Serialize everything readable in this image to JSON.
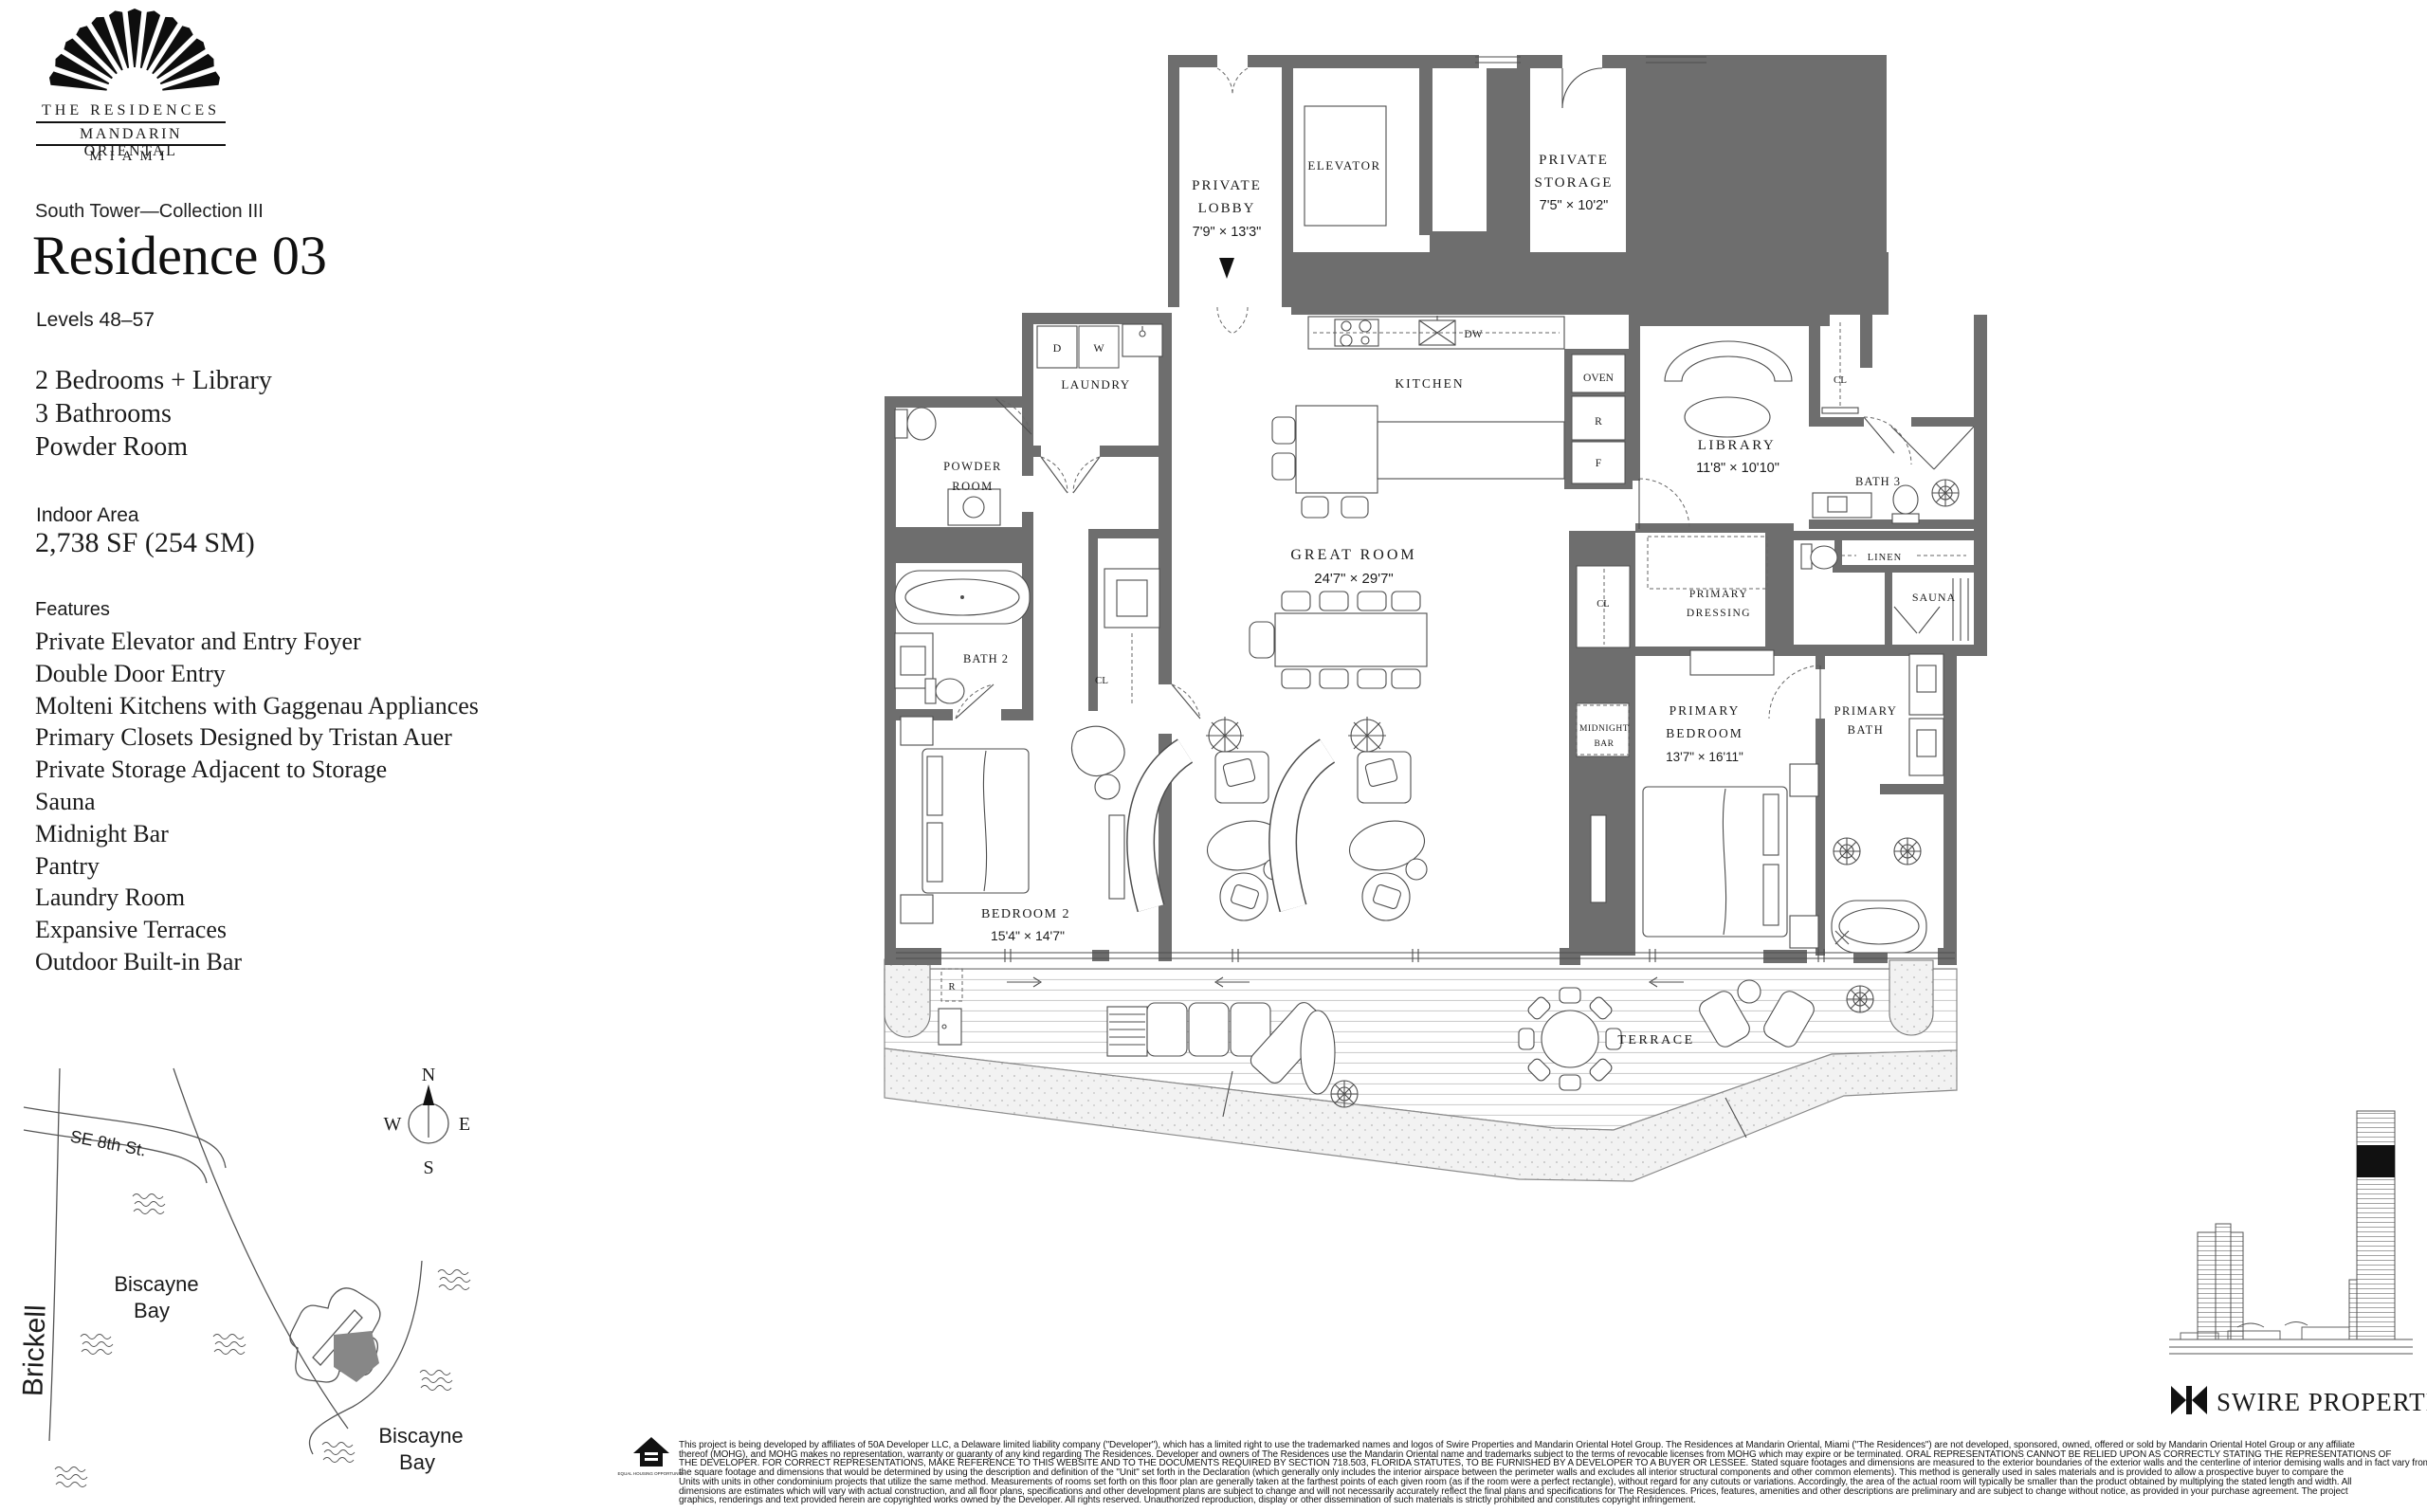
{
  "brand": {
    "fan_icon": "mandarin-oriental-fan",
    "residences": "THE RESIDENCES",
    "hotel": "MANDARIN ORIENTAL",
    "city": "MIAMI"
  },
  "header": {
    "collection": "South Tower—Collection III",
    "title": "Residence 03",
    "levels": "Levels 48–57"
  },
  "summary": {
    "lines": [
      "2 Bedrooms + Library",
      "3 Bathrooms",
      "Powder Room"
    ],
    "area_label": "Indoor Area",
    "area_value": "2,738 SF (254 SM)"
  },
  "features": {
    "label": "Features",
    "items": [
      "Private Elevator and Entry Foyer",
      "Double Door Entry",
      "Molteni Kitchens with Gaggenau Appliances",
      "Primary Closets Designed by Tristan Auer",
      "Private Storage Adjacent to Storage",
      "Sauna",
      "Midnight Bar",
      "Pantry",
      "Laundry Room",
      "Expansive Terraces",
      "Outdoor Built-in Bar"
    ]
  },
  "plan": {
    "private_lobby": {
      "l1": "PRIVATE",
      "l2": "LOBBY",
      "dims": "7'9\" × 13'3\""
    },
    "elevator": "ELEVATOR",
    "private_storage": {
      "l1": "PRIVATE",
      "l2": "STORAGE",
      "dims": "7'5\" × 10'2\""
    },
    "laundry": "LAUNDRY",
    "dryer": "D",
    "washer": "W",
    "dishwasher": "DW",
    "kitchen": "KITCHEN",
    "oven": "OVEN",
    "refrigerator": "R",
    "freezer": "F",
    "powder": {
      "l1": "POWDER",
      "l2": "ROOM"
    },
    "bath2": "BATH 2",
    "closet_bedroom2": "CL",
    "closet_hall": "CL",
    "closet_dressing": "CL",
    "great_room": {
      "l1": "GREAT ROOM",
      "dims": "24'7\" × 29'7\""
    },
    "library": {
      "l1": "LIBRARY",
      "dims": "11'8\" × 10'10\""
    },
    "bath3": "BATH 3",
    "linen": "LINEN",
    "sauna": "SAUNA",
    "dressing": {
      "l1": "PRIMARY",
      "l2": "DRESSING"
    },
    "midnight_bar": {
      "l1": "MIDNIGHT",
      "l2": "BAR"
    },
    "primary_bedroom": {
      "l1": "PRIMARY",
      "l2": "BEDROOM",
      "dims": "13'7\" × 16'11\""
    },
    "primary_bath": {
      "l1": "PRIMARY",
      "l2": "BATH"
    },
    "bedroom2": {
      "l1": "BEDROOM 2",
      "dims": "15'4\" × 14'7\""
    },
    "terrace": "TERRACE",
    "outdoor_refrigerator": "R",
    "wall_color": "#6e6e6e"
  },
  "map": {
    "street": "SE 8th St.",
    "district": "Brickell",
    "bay_a1": "Biscayne",
    "bay_a2": "Bay",
    "bay_b1": "Biscayne",
    "bay_b2": "Bay",
    "compass_n": "N",
    "compass_e": "E",
    "compass_s": "S",
    "compass_w": "W"
  },
  "footer": {
    "developer_logo": "SWIRE PROPERTIES",
    "equal_housing": "EQUAL HOUSING OPPORTUNITY",
    "disclaimer_lines": [
      "This project is being developed by affiliates of 50A Developer LLC, a Delaware limited liability company (\"Developer\"), which has a limited right to use the trademarked names and logos of Swire Properties and Mandarin Oriental Hotel Group.  The Residences at Mandarin Oriental, Miami (\"The Residences\") are not developed, sponsored, owned, offered or sold by Mandarin Oriental Hotel Group or any affiliate",
      "thereof (MOHG), and MOHG makes no representation, warranty or guaranty of any kind regarding The Residences. Developer and owners of The Residences use the Mandarin Oriental name and trademarks subject to the terms of revocable licenses from MOHG which may expire or be terminated. ORAL REPRESENTATIONS CANNOT BE RELIED UPON AS CORRECTLY STATING THE REPRESENTATIONS OF",
      "THE DEVELOPER.  FOR CORRECT REPRESENTATIONS, MAKE REFERENCE TO THIS WEBSITE AND TO THE DOCUMENTS REQUIRED BY SECTION 718.503, FLORIDA STATUTES, TO BE FURNISHED BY A DEVELOPER TO A BUYER OR LESSEE.  Stated square footages and dimensions are measured to the exterior boundaries of the exterior walls and the centerline of interior demising walls and in fact vary from",
      "the square footage and dimensions that would be determined by using the description and definition of the \"Unit\" set forth in the Declaration (which generally only includes the interior airspace between the perimeter walls and excludes all interior structural components and other common elements). This method is generally used in sales materials and is provided to allow a prospective buyer to compare the",
      "Units with units in other condominium projects that utilize the same method. Measurements of rooms set forth on this floor plan are generally taken at the farthest points of each given room (as if the room were a perfect rectangle), without regard for any cutouts or variations.  Accordingly, the area of the actual room will typically be smaller than the product obtained by multiplying the stated length and width.  All",
      "dimensions are estimates which will vary with actual construction, and all floor plans, specifications and other development plans are subject to change and will not necessarily accurately reflect the final plans and specifications for The Residences. Prices, features, amenities and other descriptions are preliminary and are subject to change without notice, as provided in your purchase agreement. The project",
      "graphics, renderings and text provided herein are copyrighted works owned by the Developer. All rights reserved. Unauthorized reproduction, display or other dissemination of such materials is strictly prohibited and constitutes copyright infringement."
    ]
  }
}
